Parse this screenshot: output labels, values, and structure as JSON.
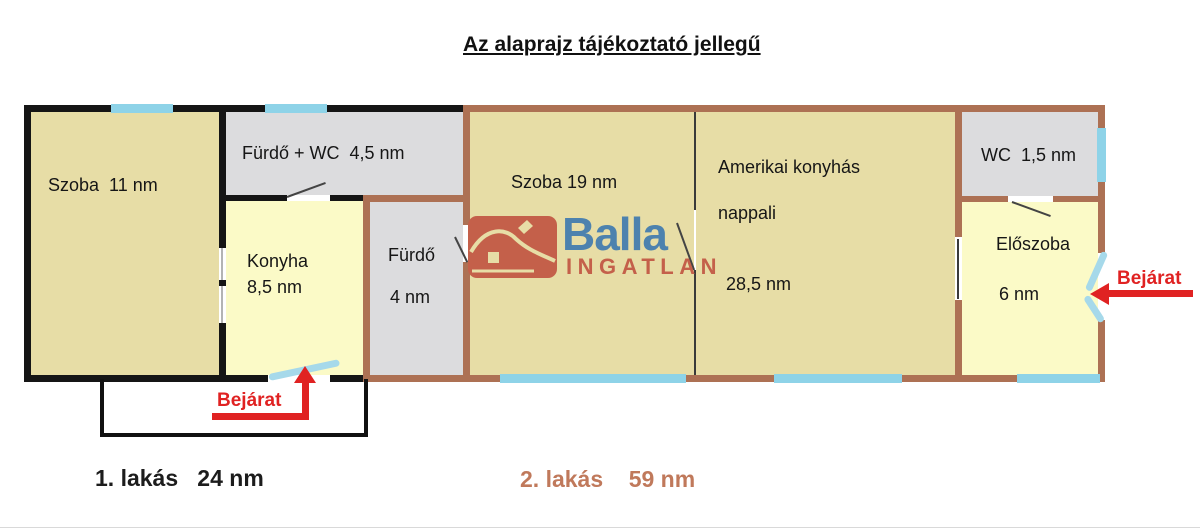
{
  "title": "Az alaprajz tájékoztató jellegű",
  "logo": {
    "brand": "Balla",
    "sub": "INGATLAN"
  },
  "rooms": {
    "szoba11": {
      "label": "Szoba  11 nm"
    },
    "furdo_wc": {
      "label": "Fürdő + WC  4,5 nm"
    },
    "konyha": {
      "name": "Konyha",
      "area": "8,5 nm"
    },
    "furdo4": {
      "name": "Fürdő",
      "area": "4 nm"
    },
    "szoba19": {
      "label": "Szoba 19 nm"
    },
    "nappali": {
      "name_line1": "Amerikai konyhás",
      "name_line2": "nappali",
      "area": "28,5 nm"
    },
    "wc": {
      "label": "WC  1,5 nm"
    },
    "eloszoba": {
      "name": "Előszoba",
      "area": "6 nm"
    }
  },
  "entrances": {
    "apartment1": {
      "label": "Bejárat"
    },
    "apartment2": {
      "label": "Bejárat"
    }
  },
  "apartments": {
    "one": {
      "label": "1. lakás   24 nm"
    },
    "two": {
      "label": "2. lakás    59 nm"
    }
  },
  "colors": {
    "room_tan": "#e7dda6",
    "room_gray": "#dcdcde",
    "room_yellow": "#fbfac7",
    "wall_black": "#151515",
    "wall_brown": "#ad7154",
    "window_cyan": "#8ed3e8",
    "door_cyan": "#a6d9ea",
    "arrow_red": "#e02222",
    "logo_blue": "#4d82ae",
    "logo_terracotta": "#c4604a",
    "apartment2_text": "#c0795b"
  }
}
